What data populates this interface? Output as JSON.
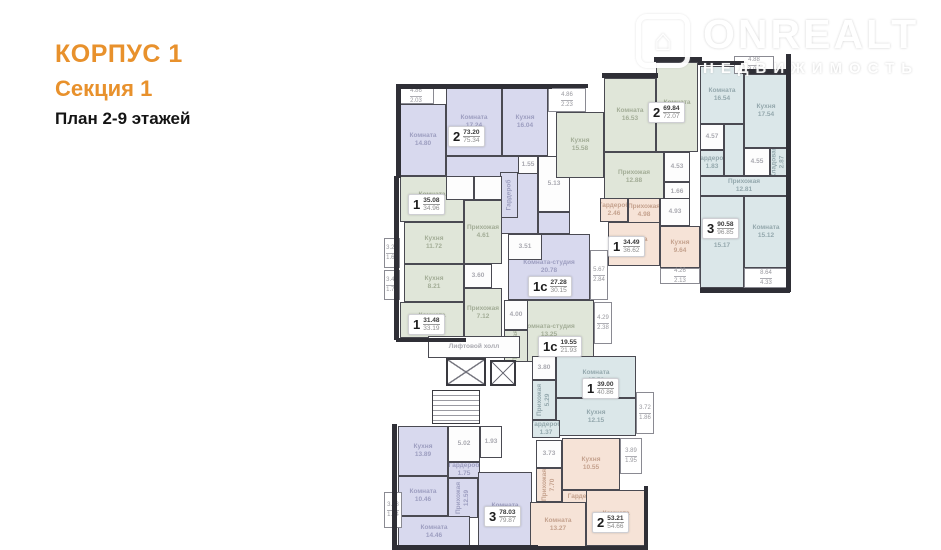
{
  "header": {
    "korpus": "КОРПУС 1",
    "sekcia": "Секция 1",
    "plan_floors": "План 2-9 этажей"
  },
  "watermark": {
    "brand": "ONREALT",
    "tagline": "НЕДВИЖИМОСТЬ",
    "icon": "house-icon",
    "icon_glyph": "⌂"
  },
  "palette": {
    "accent_orange": "#e8912c",
    "wall_dark": "#2f2f36",
    "apartment_purple": "#d8d9ee",
    "apartment_green": "#e0e6d9",
    "apartment_blue": "#dbe7e9",
    "apartment_beige": "#f6e3d7",
    "service_white": "#fdfdfd"
  },
  "plan": {
    "rooms": [
      {
        "n": "Комната",
        "a": "14.80",
        "c": "p",
        "x": 400,
        "y": 104,
        "w": 46,
        "h": 72
      },
      {
        "n": "Комната",
        "a": "17.24",
        "c": "p",
        "x": 446,
        "y": 88,
        "w": 56,
        "h": 68
      },
      {
        "n": "Кухня",
        "a": "16.04",
        "c": "p",
        "x": 502,
        "y": 88,
        "w": 46,
        "h": 68
      },
      {
        "n": "Прихожая",
        "a": "15.67",
        "c": "p",
        "x": 446,
        "y": 156,
        "w": 92,
        "h": 78
      },
      {
        "n": "",
        "a": "",
        "c": "p",
        "x": 538,
        "y": 212,
        "w": 32,
        "h": 22
      },
      {
        "n": "Гардероб",
        "a": "",
        "c": "p",
        "x": 500,
        "y": 172,
        "w": 18,
        "h": 46,
        "v": 1
      },
      {
        "n": "",
        "a": "1.55",
        "c": "w",
        "x": 518,
        "y": 156,
        "w": 20,
        "h": 18
      },
      {
        "n": "",
        "a": "5.13",
        "c": "w",
        "x": 538,
        "y": 156,
        "w": 32,
        "h": 56
      },
      {
        "n": "Комната",
        "a": "13.05",
        "c": "g",
        "x": 400,
        "y": 176,
        "w": 64,
        "h": 46
      },
      {
        "n": "",
        "a": "",
        "c": "w",
        "x": 446,
        "y": 176,
        "w": 28,
        "h": 24
      },
      {
        "n": "",
        "a": "",
        "c": "w",
        "x": 474,
        "y": 176,
        "w": 28,
        "h": 24
      },
      {
        "n": "Кухня",
        "a": "11.72",
        "c": "g",
        "x": 404,
        "y": 222,
        "w": 60,
        "h": 42
      },
      {
        "n": "Прихожая",
        "a": "4.61",
        "c": "g",
        "x": 464,
        "y": 200,
        "w": 38,
        "h": 64
      },
      {
        "n": "Кухня",
        "a": "8.21",
        "c": "g",
        "x": 404,
        "y": 264,
        "w": 60,
        "h": 38
      },
      {
        "n": "Комната",
        "a": "12.53",
        "c": "g",
        "x": 400,
        "y": 302,
        "w": 64,
        "h": 36
      },
      {
        "n": "Прихожая",
        "a": "7.12",
        "c": "g",
        "x": 464,
        "y": 288,
        "w": 38,
        "h": 50
      },
      {
        "n": "",
        "a": "3.60",
        "c": "w",
        "x": 464,
        "y": 264,
        "w": 28,
        "h": 24
      },
      {
        "n": "Комната-студия",
        "a": "20.78",
        "c": "p",
        "x": 508,
        "y": 234,
        "w": 82,
        "h": 66
      },
      {
        "n": "",
        "a": "3.51",
        "c": "w",
        "x": 508,
        "y": 234,
        "w": 34,
        "h": 26
      },
      {
        "n": "Комната-студия",
        "a": "13.25",
        "c": "g",
        "x": 504,
        "y": 300,
        "w": 90,
        "h": 62
      },
      {
        "n": "",
        "a": "4.00",
        "c": "w",
        "x": 504,
        "y": 300,
        "w": 24,
        "h": 30
      },
      {
        "n": "Прихожая",
        "a": "",
        "c": "g",
        "x": 504,
        "y": 330,
        "w": 24,
        "h": 32,
        "v": 1
      },
      {
        "n": "Комната",
        "a": "15.53",
        "c": "b",
        "x": 556,
        "y": 356,
        "w": 80,
        "h": 42
      },
      {
        "n": "Кухня",
        "a": "12.15",
        "c": "b",
        "x": 556,
        "y": 398,
        "w": 80,
        "h": 38
      },
      {
        "n": "Прихожая",
        "a": "5.29",
        "c": "b",
        "x": 532,
        "y": 380,
        "w": 24,
        "h": 40,
        "v": 1
      },
      {
        "n": "",
        "a": "3.80",
        "c": "w",
        "x": 532,
        "y": 356,
        "w": 24,
        "h": 24
      },
      {
        "n": "Гардероб",
        "a": "1.37",
        "c": "b",
        "x": 532,
        "y": 420,
        "w": 28,
        "h": 18
      },
      {
        "n": "Кухня",
        "a": "15.58",
        "c": "g",
        "x": 556,
        "y": 112,
        "w": 48,
        "h": 66
      },
      {
        "n": "Комната",
        "a": "16.53",
        "c": "g",
        "x": 604,
        "y": 78,
        "w": 52,
        "h": 74
      },
      {
        "n": "Комната",
        "a": "20.84",
        "c": "g",
        "x": 656,
        "y": 62,
        "w": 42,
        "h": 90
      },
      {
        "n": "Прихожая",
        "a": "12.88",
        "c": "g",
        "x": 604,
        "y": 152,
        "w": 60,
        "h": 50
      },
      {
        "n": "",
        "a": "4.53",
        "c": "w",
        "x": 664,
        "y": 152,
        "w": 26,
        "h": 30
      },
      {
        "n": "",
        "a": "1.66",
        "c": "w",
        "x": 664,
        "y": 182,
        "w": 26,
        "h": 20
      },
      {
        "n": "Комната",
        "a": "16.54",
        "c": "b",
        "x": 700,
        "y": 66,
        "w": 44,
        "h": 58
      },
      {
        "n": "Кухня",
        "a": "17.54",
        "c": "b",
        "x": 744,
        "y": 74,
        "w": 44,
        "h": 74
      },
      {
        "n": "",
        "a": "4.57",
        "c": "w",
        "x": 700,
        "y": 124,
        "w": 24,
        "h": 26
      },
      {
        "n": "Гардероб",
        "a": "1.83",
        "c": "b",
        "x": 700,
        "y": 150,
        "w": 24,
        "h": 26
      },
      {
        "n": "",
        "a": "",
        "c": "b",
        "x": 724,
        "y": 124,
        "w": 20,
        "h": 52
      },
      {
        "n": "Прихожая",
        "a": "12.81",
        "c": "b",
        "x": 700,
        "y": 176,
        "w": 88,
        "h": 20
      },
      {
        "n": "",
        "a": "4.55",
        "c": "w",
        "x": 744,
        "y": 148,
        "w": 26,
        "h": 28
      },
      {
        "n": "Кладовая",
        "a": "2.87",
        "c": "b",
        "x": 770,
        "y": 148,
        "w": 18,
        "h": 28,
        "v": 1
      },
      {
        "n": "Комната",
        "a": "15.17",
        "c": "b",
        "x": 700,
        "y": 196,
        "w": 44,
        "h": 92
      },
      {
        "n": "Комната",
        "a": "15.12",
        "c": "b",
        "x": 744,
        "y": 196,
        "w": 44,
        "h": 72
      },
      {
        "n": "Гардероб",
        "a": "2.46",
        "c": "be",
        "x": 600,
        "y": 198,
        "w": 28,
        "h": 24
      },
      {
        "n": "Прихожая",
        "a": "4.98",
        "c": "be",
        "x": 628,
        "y": 198,
        "w": 32,
        "h": 26
      },
      {
        "n": "",
        "a": "4.93",
        "c": "w",
        "x": 660,
        "y": 198,
        "w": 30,
        "h": 28
      },
      {
        "n": "Комната",
        "a": "12.48",
        "c": "be",
        "x": 608,
        "y": 222,
        "w": 52,
        "h": 44
      },
      {
        "n": "Кухня",
        "a": "9.64",
        "c": "be",
        "x": 660,
        "y": 226,
        "w": 40,
        "h": 42
      },
      {
        "n": "Кухня",
        "a": "13.89",
        "c": "p",
        "x": 398,
        "y": 426,
        "w": 50,
        "h": 50
      },
      {
        "n": "",
        "a": "5.02",
        "c": "w",
        "x": 448,
        "y": 426,
        "w": 32,
        "h": 36
      },
      {
        "n": "",
        "a": "1.93",
        "c": "w",
        "x": 480,
        "y": 426,
        "w": 22,
        "h": 32
      },
      {
        "n": "Гардероб",
        "a": "1.75",
        "c": "p",
        "x": 448,
        "y": 462,
        "w": 32,
        "h": 16
      },
      {
        "n": "Прихожая",
        "a": "12.59",
        "c": "p",
        "x": 448,
        "y": 478,
        "w": 30,
        "h": 40,
        "v": 1
      },
      {
        "n": "Комната",
        "a": "10.46",
        "c": "p",
        "x": 398,
        "y": 476,
        "w": 50,
        "h": 40
      },
      {
        "n": "Комната",
        "a": "14.46",
        "c": "p",
        "x": 398,
        "y": 516,
        "w": 72,
        "h": 32
      },
      {
        "n": "Комната",
        "a": "18.17",
        "c": "p",
        "x": 478,
        "y": 472,
        "w": 54,
        "h": 76
      },
      {
        "n": "",
        "a": "3.73",
        "c": "w",
        "x": 536,
        "y": 440,
        "w": 26,
        "h": 28
      },
      {
        "n": "Прихожая",
        "a": "7.70",
        "c": "be",
        "x": 536,
        "y": 468,
        "w": 26,
        "h": 34,
        "v": 1
      },
      {
        "n": "Кухня",
        "a": "10.55",
        "c": "be",
        "x": 562,
        "y": 438,
        "w": 58,
        "h": 52
      },
      {
        "n": "Гардероб",
        "a": "",
        "c": "be",
        "x": 562,
        "y": 490,
        "w": 42,
        "h": 14
      },
      {
        "n": "Комната",
        "a": "13.27",
        "c": "be",
        "x": 530,
        "y": 502,
        "w": 56,
        "h": 46
      },
      {
        "n": "Комната",
        "a": "15.05",
        "c": "be",
        "x": 586,
        "y": 490,
        "w": 60,
        "h": 56
      },
      {
        "n": "Лифтовой холл",
        "a": "",
        "c": "w",
        "x": 428,
        "y": 336,
        "w": 92,
        "h": 22,
        "id": "elevator-hall"
      }
    ],
    "balconies": [
      {
        "a1": "4.86",
        "a2": "2.03",
        "x": 398,
        "y": 88,
        "w": 36,
        "h": 16
      },
      {
        "a1": "4.86",
        "a2": "2.23",
        "x": 548,
        "y": 88,
        "w": 38,
        "h": 24
      },
      {
        "a1": "4.88",
        "a2": "3.94",
        "x": 734,
        "y": 56,
        "w": 40,
        "h": 18
      },
      {
        "a1": "3.25",
        "a2": "1.68",
        "x": 384,
        "y": 238,
        "w": 16,
        "h": 30
      },
      {
        "a1": "3.46",
        "a2": "1.73",
        "x": 384,
        "y": 270,
        "w": 16,
        "h": 30
      },
      {
        "a1": "5.67",
        "a2": "2.84",
        "x": 590,
        "y": 250,
        "w": 18,
        "h": 50
      },
      {
        "a1": "4.29",
        "a2": "2.38",
        "x": 594,
        "y": 302,
        "w": 18,
        "h": 42
      },
      {
        "a1": "3.72",
        "a2": "1.86",
        "x": 636,
        "y": 392,
        "w": 18,
        "h": 42
      },
      {
        "a1": "4.26",
        "a2": "2.13",
        "x": 660,
        "y": 268,
        "w": 40,
        "h": 16
      },
      {
        "a1": "8.64",
        "a2": "4.33",
        "x": 744,
        "y": 268,
        "w": 44,
        "h": 20
      },
      {
        "a1": "3.68",
        "a2": "1.84",
        "x": 384,
        "y": 492,
        "w": 18,
        "h": 36
      },
      {
        "a1": "3.89",
        "a2": "1.95",
        "x": 620,
        "y": 438,
        "w": 22,
        "h": 36
      }
    ],
    "badges": [
      {
        "t": "2",
        "a1": "73.20",
        "a2": "75.34",
        "x": 448,
        "y": 126
      },
      {
        "t": "1",
        "a1": "35.08",
        "a2": "34.96",
        "x": 408,
        "y": 194
      },
      {
        "t": "1",
        "a1": "31.48",
        "a2": "33.19",
        "x": 408,
        "y": 314
      },
      {
        "t": "1с",
        "a1": "27.28",
        "a2": "30.15",
        "x": 528,
        "y": 276
      },
      {
        "t": "1с",
        "a1": "19.55",
        "a2": "21.93",
        "x": 538,
        "y": 336
      },
      {
        "t": "1",
        "a1": "39.00",
        "a2": "40.86",
        "x": 582,
        "y": 378
      },
      {
        "t": "2",
        "a1": "69.84",
        "a2": "72.07",
        "x": 648,
        "y": 102
      },
      {
        "t": "3",
        "a1": "90.58",
        "a2": "96.85",
        "x": 702,
        "y": 218
      },
      {
        "t": "1",
        "a1": "34.49",
        "a2": "36.62",
        "x": 608,
        "y": 236
      },
      {
        "t": "3",
        "a1": "78.03",
        "a2": "79.87",
        "x": 484,
        "y": 506
      },
      {
        "t": "2",
        "a1": "53.21",
        "a2": "54.66",
        "x": 592,
        "y": 512
      }
    ],
    "walls": [
      [
        396,
        84,
        156,
        5
      ],
      [
        544,
        84,
        44,
        4
      ],
      [
        602,
        73,
        56,
        5
      ],
      [
        654,
        57,
        48,
        5
      ],
      [
        698,
        61,
        46,
        4
      ],
      [
        742,
        69,
        48,
        5
      ],
      [
        786,
        54,
        5,
        238
      ],
      [
        700,
        288,
        90,
        5
      ],
      [
        396,
        84,
        5,
        94
      ],
      [
        394,
        176,
        5,
        164
      ],
      [
        396,
        338,
        70,
        4
      ],
      [
        392,
        424,
        5,
        126
      ],
      [
        396,
        545,
        142,
        5
      ],
      [
        528,
        546,
        120,
        4
      ],
      [
        644,
        486,
        4,
        62
      ]
    ],
    "lifts": [
      {
        "x": 446,
        "y": 358,
        "w": 40,
        "h": 28
      },
      {
        "x": 490,
        "y": 360,
        "w": 26,
        "h": 26
      }
    ],
    "stairs": {
      "x": 432,
      "y": 390,
      "w": 48,
      "h": 34
    }
  }
}
